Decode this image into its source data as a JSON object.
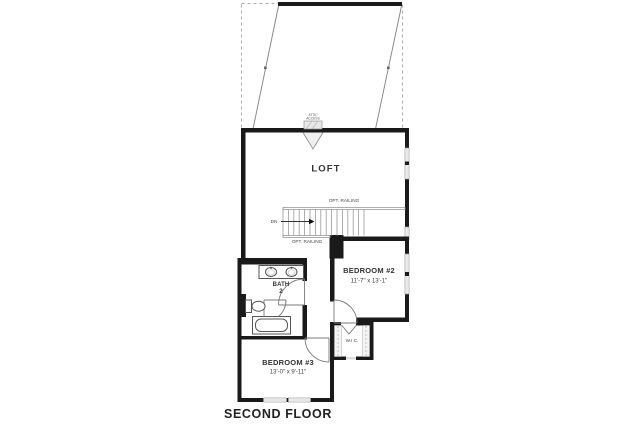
{
  "title": "SECOND FLOOR",
  "colors": {
    "wall": "#1a1a1a",
    "line": "#555555",
    "light_line": "#9a9a9a",
    "dash": "#aaaaaa",
    "text": "#333333",
    "window_fill": "#ffffff",
    "fixture_fill": "#ffffff",
    "hatch_fill": "#e8e8e8"
  },
  "rooms": {
    "loft": {
      "label": "LOFT"
    },
    "bedroom2": {
      "label": "BEDROOM #2",
      "dimensions": "11'-7\" x 13'-1\""
    },
    "bedroom3": {
      "label": "BEDROOM #3",
      "dimensions": "13'-0\" x 9'-11\""
    },
    "bath": {
      "label": "BATH",
      "number": "2"
    },
    "wic": {
      "label": "W.I.C."
    }
  },
  "stairs": {
    "direction_label": "DN",
    "railing_label_top": "OPT. RAILING",
    "railing_label_bottom": "OPT. RAILING"
  },
  "attic": {
    "label_line1": "ATTIC",
    "label_line2": "ACCESS"
  }
}
